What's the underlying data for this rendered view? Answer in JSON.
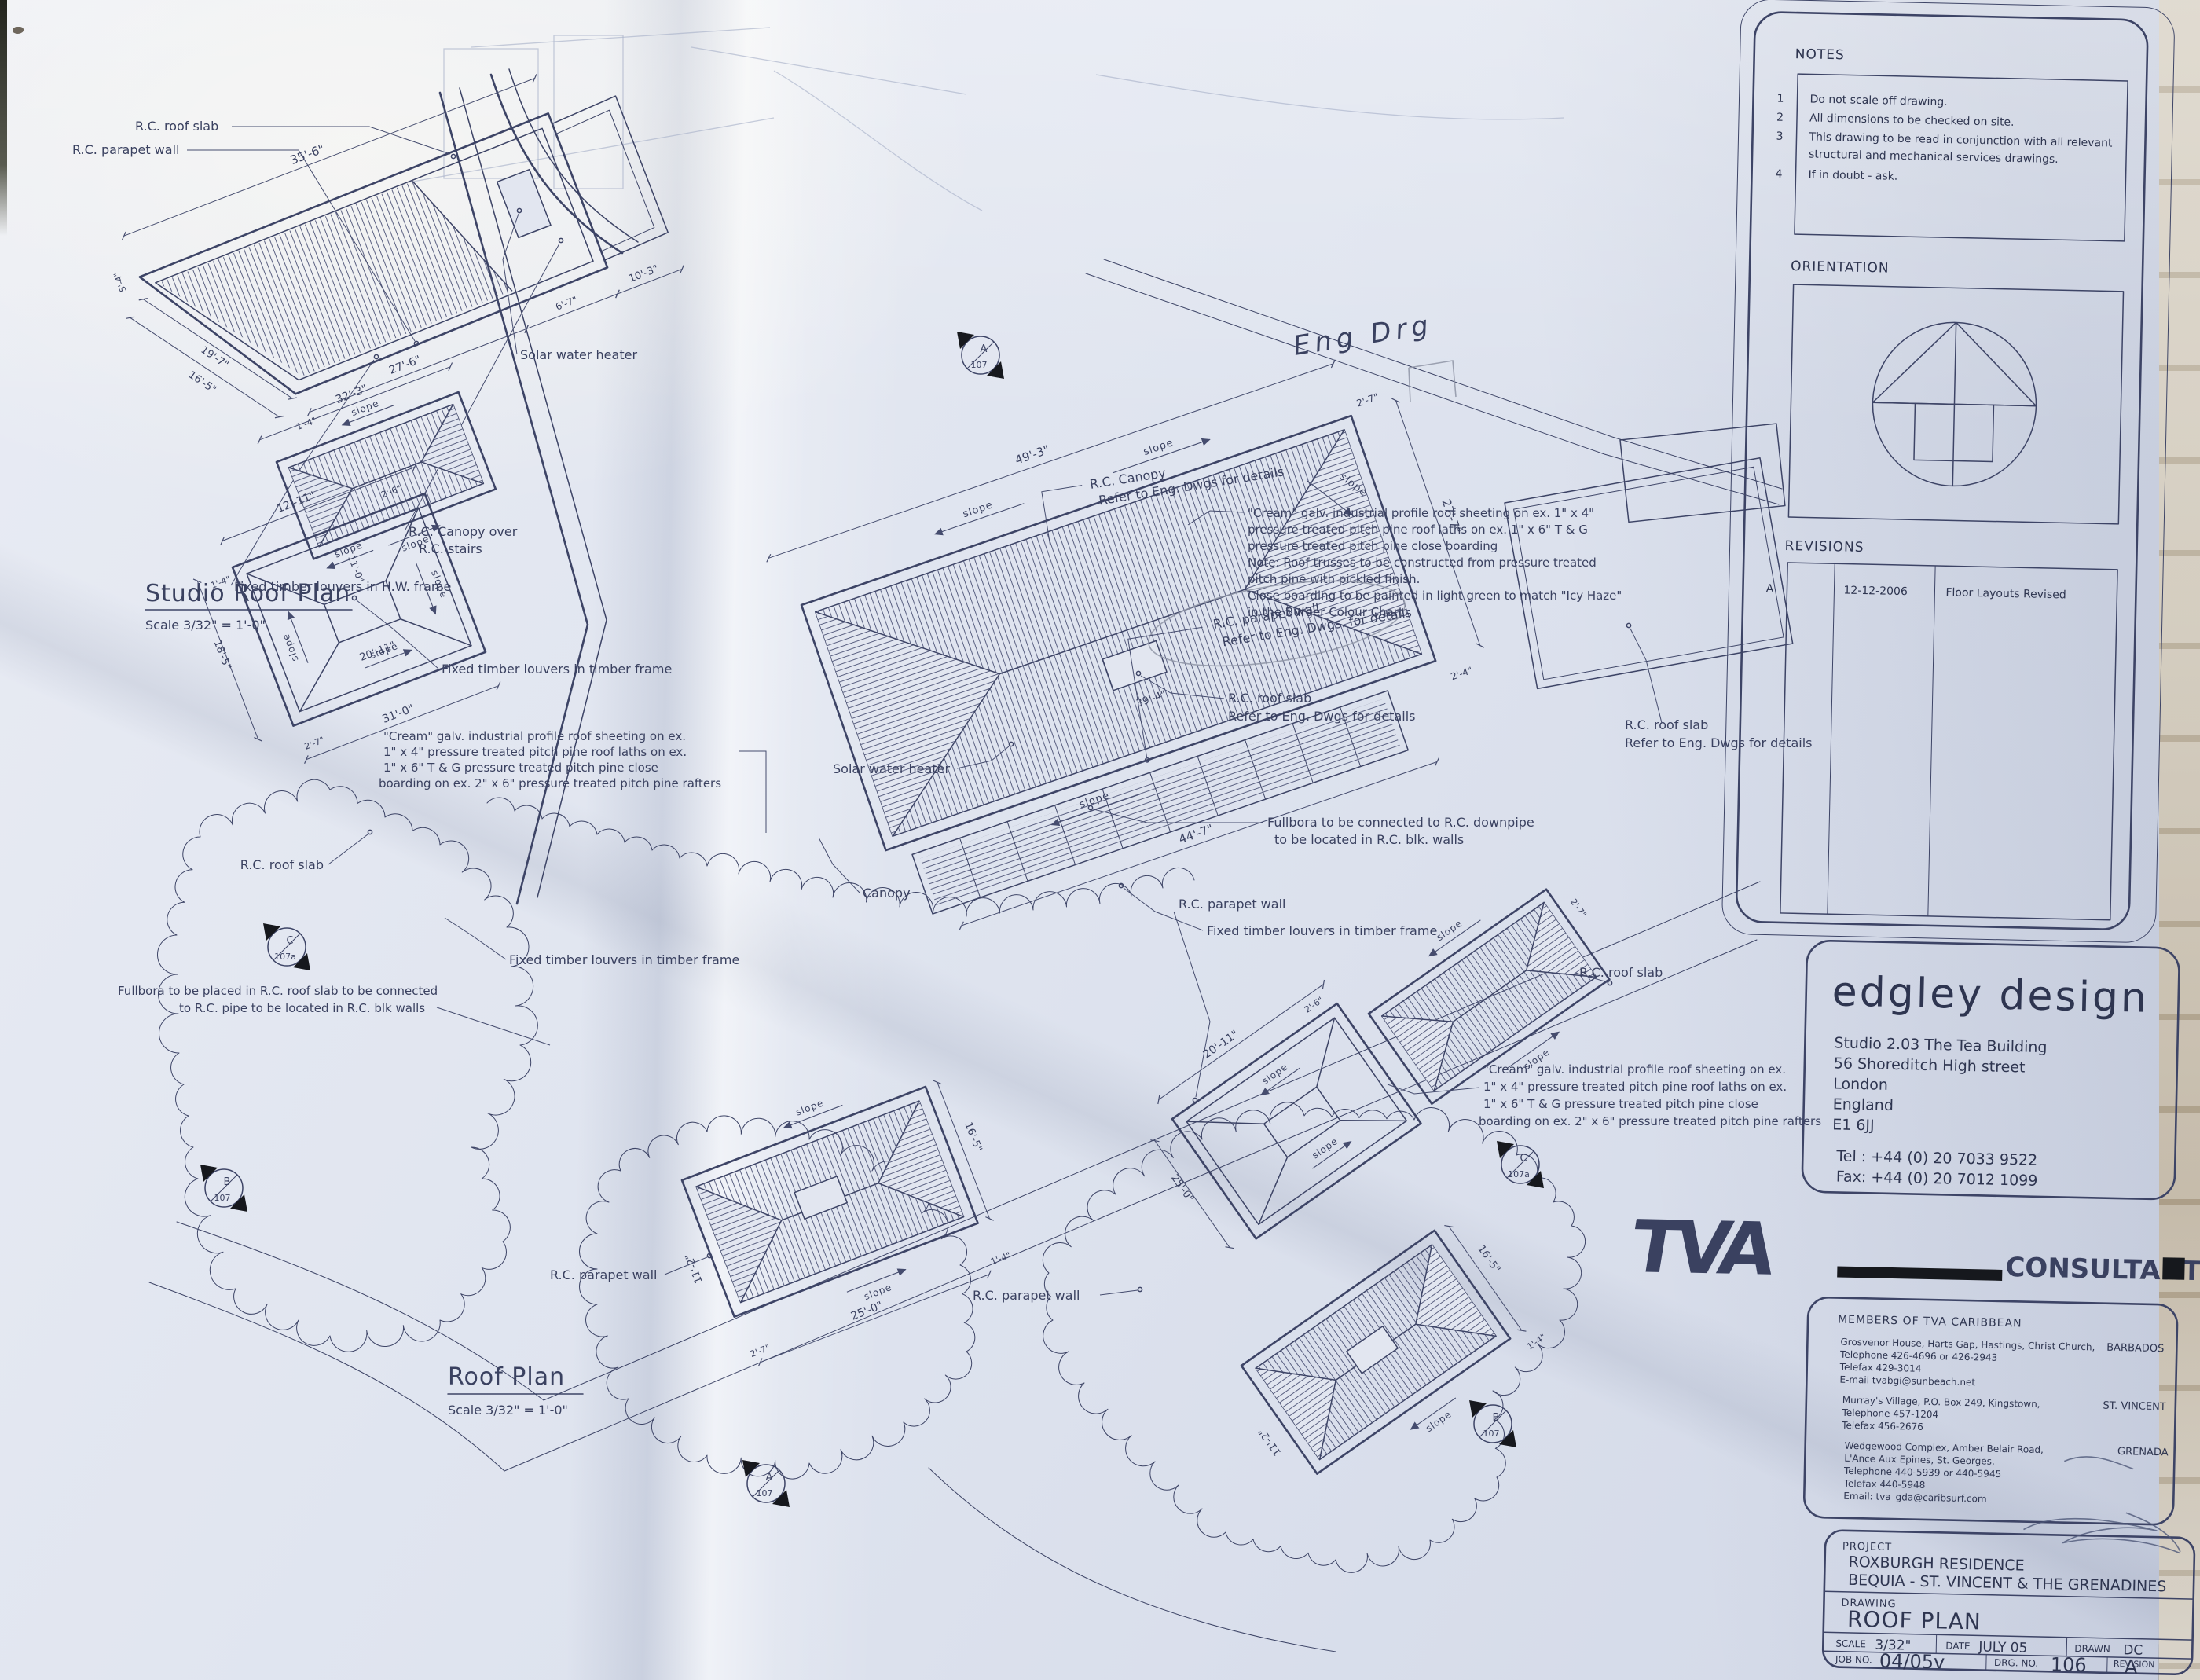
{
  "labels": {
    "rc_roof_slab": "R.C. roof slab",
    "rc_parapet_wall": "R.C. parapet wall",
    "refer_eng": "Refer to Eng. Dwgs for details",
    "refer_eng2": "Refer to Eng. Dwgs. for details",
    "solar_water_heater": "Solar water heater",
    "rc_canopy_over": "R.C. Canopy over",
    "rc_stairs": "R.C. stairs",
    "rc_canopy": "R.C. Canopy",
    "canopy": "Canopy",
    "slope": "slope",
    "fixed_louvers_hw": "Fixed timber louvers in H.W. frame",
    "fixed_louvers_timber": "Fixed timber louvers in timber frame",
    "fullbora_downpipe_1": "Fullbora to be connected to R.C. downpipe",
    "fullbora_downpipe_2": "to be located in R.C. blk. walls",
    "fullbora_placed_1": "Fullbora to be placed in R.C. roof slab to be connected",
    "fullbora_placed_2": "to R.C. pipe to be located in R.C. blk walls",
    "pencil_note": "Eng Drg"
  },
  "spec_note_main": [
    "\"Cream\" galv. industrial profile roof sheeting on ex. 1\" x 4\"",
    "pressure treated pitch pine roof laths on ex. 1\" x 6\" T & G",
    "pressure treated pitch pine close boarding",
    "Note:  Roof trusses to be constructed from pressure treated",
    "pitch pine with pickled finish.",
    "Close boarding to be painted in light green to match \"Icy Haze\"",
    "in the Burger Colour Chart"
  ],
  "spec_note_wing": [
    "\"Cream\" galv. industrial profile roof sheeting on ex.",
    "1\" x 4\" pressure treated pitch pine roof laths on ex.",
    "1\" x 6\" T & G pressure treated pitch pine close",
    "boarding on ex. 2\" x 6\" pressure treated pitch pine rafters"
  ],
  "titles": {
    "studio": "Studio Roof Plan",
    "studio_scale": "Scale  3/32\" = 1'-0\"",
    "main": "Roof Plan",
    "main_scale": "Scale  3/32\" = 1'-0\""
  },
  "dims": {
    "studio": [
      "35'-6\"",
      "27'-6\"",
      "10'-3\"",
      "6'-7\"",
      "19'-7\"",
      "16'-5\"",
      "5'-4\"",
      "1'-4\""
    ],
    "main": [
      "49'-3\"",
      "44'-7\"",
      "27'-7\"",
      "2'-7\"",
      "2'-4\"",
      "39'-4\""
    ],
    "wing_w": [
      "32'-3\"",
      "12'-11\"",
      "20'-11\"",
      "11'-0\"",
      "31'-0\"",
      "18'-5\"",
      "2'-7\"",
      "2'-6\"",
      "1'-4\""
    ],
    "wing_s": [
      "25'-0\"",
      "16'-5\"",
      "11'-2\"",
      "2'-7\"",
      "1'-4\""
    ],
    "wing_e": [
      "20'-11\"",
      "2'-6\"",
      "25'-0\"",
      "16'-5\"",
      "11'-2\"",
      "1'-4\"",
      "2'-7\""
    ]
  },
  "markers": {
    "a": {
      "letter": "A",
      "num": "107"
    },
    "b": {
      "letter": "B",
      "num": "107"
    },
    "c": {
      "letter": "C",
      "num": "107a"
    }
  },
  "panel": {
    "notes_title": "NOTES",
    "notes": [
      {
        "n": "1",
        "lines": [
          "Do not scale off drawing."
        ]
      },
      {
        "n": "2",
        "lines": [
          "All dimensions to be checked on site."
        ]
      },
      {
        "n": "3",
        "lines": [
          "This drawing to be read in conjunction with all relevant",
          "structural and mechanical services drawings."
        ]
      },
      {
        "n": "4",
        "lines": [
          "If in doubt - ask."
        ]
      }
    ],
    "orientation_title": "ORIENTATION",
    "revisions_title": "REVISIONS",
    "revisions": [
      {
        "rev": "A",
        "date": "12-12-2006",
        "desc": "Floor Layouts Revised"
      }
    ]
  },
  "firm": {
    "name": "edgley design",
    "address": [
      "Studio 2.03 The Tea Building",
      "56 Shoreditch High street",
      "London",
      "England",
      "E1 6JJ"
    ],
    "tel": "Tel : +44 (0) 20 7033 9522",
    "fax": "Fax: +44 (0) 20 7012 1099"
  },
  "consultants": {
    "logo": "TVA",
    "name": "CONSULTANTS LTD",
    "members_title": "MEMBERS OF TVA CARIBBEAN",
    "offices": [
      {
        "lines": [
          "Grosvenor House, Harts Gap, Hastings, Christ Church,",
          "Telephone 426-4696 or 426-2943",
          "Telefax 429-3014",
          "E-mail tvabgi@sunbeach.net"
        ],
        "country": "BARBADOS"
      },
      {
        "lines": [
          "Murray's Village, P.O. Box 249, Kingstown,",
          "Telephone 457-1204",
          "Telefax 456-2676"
        ],
        "country": "ST. VINCENT"
      },
      {
        "lines": [
          "Wedgewood Complex, Amber Belair Road,",
          "L'Ance Aux Epines, St. Georges,",
          "Telephone 440-5939 or 440-5945",
          "Telefax 440-5948",
          "Email:  tva_gda@caribsurf.com"
        ],
        "country": "GRENADA"
      }
    ]
  },
  "titleblock": {
    "project_label": "PROJECT",
    "project": [
      "ROXBURGH RESIDENCE",
      "BEQUIA - ST. VINCENT & THE GRENADINES"
    ],
    "drawing_label": "DRAWING",
    "drawing": "ROOF PLAN",
    "scale_label": "SCALE",
    "scale": "3/32\"",
    "date_label": "DATE",
    "date": "JULY 05",
    "drawn_label": "DRAWN",
    "drawn": "DC",
    "job_label": "JOB NO.",
    "job": "04/05v",
    "drg_label": "DRG. NO.",
    "drg": "106",
    "rev_label": "REVISION",
    "rev": "A"
  }
}
